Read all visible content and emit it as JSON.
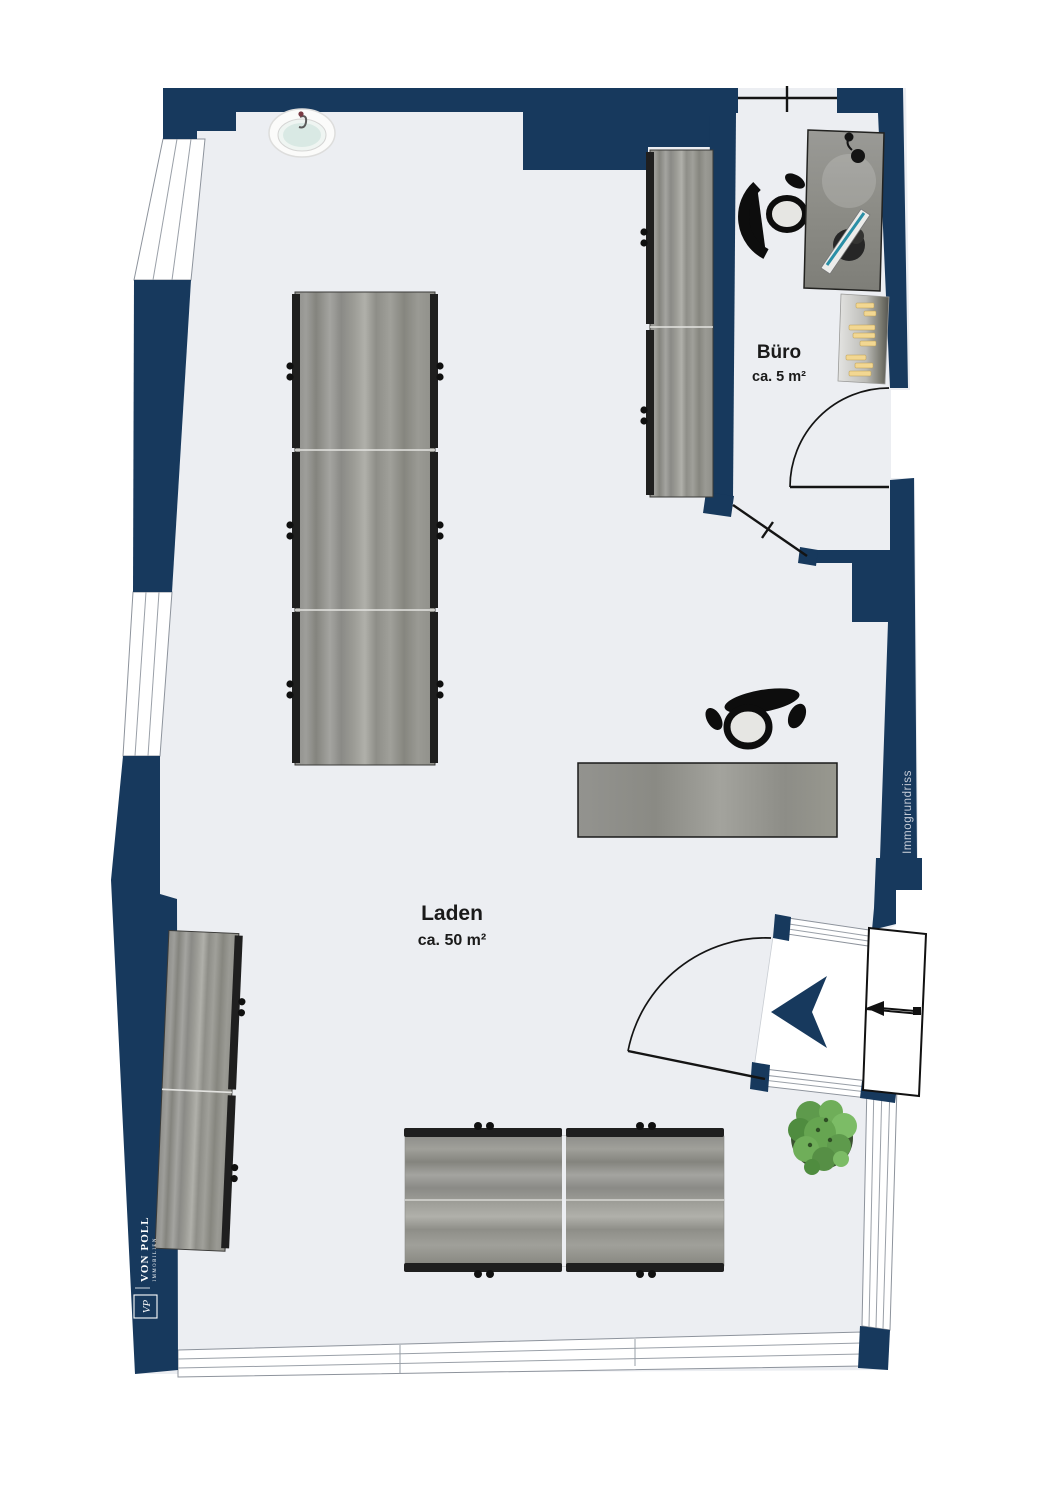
{
  "plan": {
    "rooms": [
      {
        "name": "Laden",
        "area": "ca. 50 m²"
      },
      {
        "name": "Büro",
        "area": "ca. 5 m²"
      }
    ],
    "watermark": "Immogrundriss",
    "branding": {
      "monogram": "VP",
      "name": "VON POLL",
      "subtitle": "IMMOBILIEN"
    },
    "colors": {
      "wall": "#17395D",
      "floor": "#ECEEF2",
      "label": "#1A1A1A",
      "watermark_text": "#C7CDD8",
      "plant": "#5E9A4C",
      "radiator_items": "#F2D792",
      "monitor_screen": "#2A8FA6"
    }
  }
}
